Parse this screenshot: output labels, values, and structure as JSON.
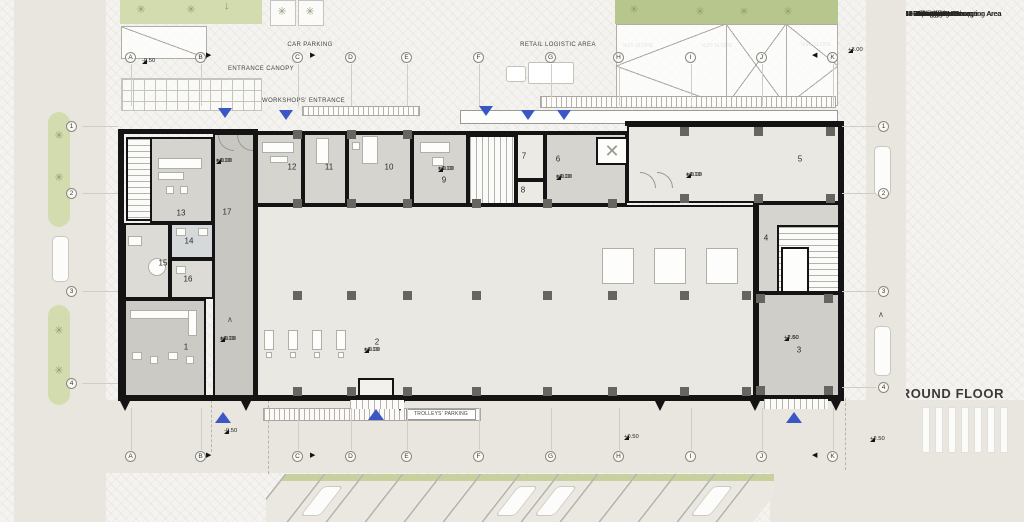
{
  "title": "GROUND FLOOR",
  "legend": {
    "items": [
      "1- Reception Area",
      "2- Supermarket Shopping Area",
      "3- Retail Store Area",
      "4- Storage",
      "5- Storage",
      "6- Loading Zone",
      "7- Waste Area",
      "8- Staircase",
      "9- Office",
      "10-Automation",
      "11-Accounting",
      "12-Manager Room",
      "13-Villa Offices Reception Area",
      "14-WC",
      "15-Security Restroom",
      "16-Dressing",
      "17-Pedestrian Passage"
    ]
  },
  "labels": {
    "car_parking": "CAR PARKING",
    "entrance_canopy": "ENTRANCE CANOPY",
    "workshops_entrance": "WORKSHOPS' ENTRANCE",
    "retail_logistic_area": "RETAIL LOGISTIC AREA",
    "generator_area": "POSSIBLE AREA FOR GENERATOR AND BOILER DEVICE",
    "trolleys_parking": "TROLLEYS' PARKING",
    "slope_left": "%10 SLOPE",
    "slope_center": "%20 SLOPE",
    "slope_right": "%10 SLOPE",
    "slope_small": "% 5 Slope"
  },
  "grid": {
    "letters": [
      "A",
      "B",
      "C",
      "D",
      "E",
      "F",
      "G",
      "H",
      "I",
      "J",
      "K"
    ],
    "numbers": [
      "1",
      "2",
      "3",
      "4"
    ]
  },
  "rooms": {
    "numbers": [
      "1",
      "2",
      "3",
      "4",
      "5",
      "6",
      "7",
      "8",
      "9",
      "10",
      "11",
      "12",
      "13",
      "14",
      "15",
      "16",
      "17"
    ]
  },
  "elevations": {
    "floor_upper": "+0.10",
    "floor_lower": "± 0.00",
    "retail_upper": "+2.60",
    "retail_lower": "+2.50",
    "site": [
      "-0.50",
      "+3.00",
      "-0.50",
      "+0.50",
      "+2.50"
    ]
  },
  "icons": {
    "tree": "✳",
    "arrow_right": "▶",
    "arrow_left": "◀",
    "chevron_up": "∧",
    "arrow_down": "↓",
    "shaft_x": "✕"
  },
  "colors": {
    "accent_blue": "#3a57c3",
    "green_light": "#d3dcae",
    "green_dark": "#b7c68d",
    "wall": "#141414",
    "road": "#e9e6e0",
    "building_light": "#e9e8e3",
    "building_mid": "#d5d4cf",
    "building_dark": "#cbcac5"
  }
}
